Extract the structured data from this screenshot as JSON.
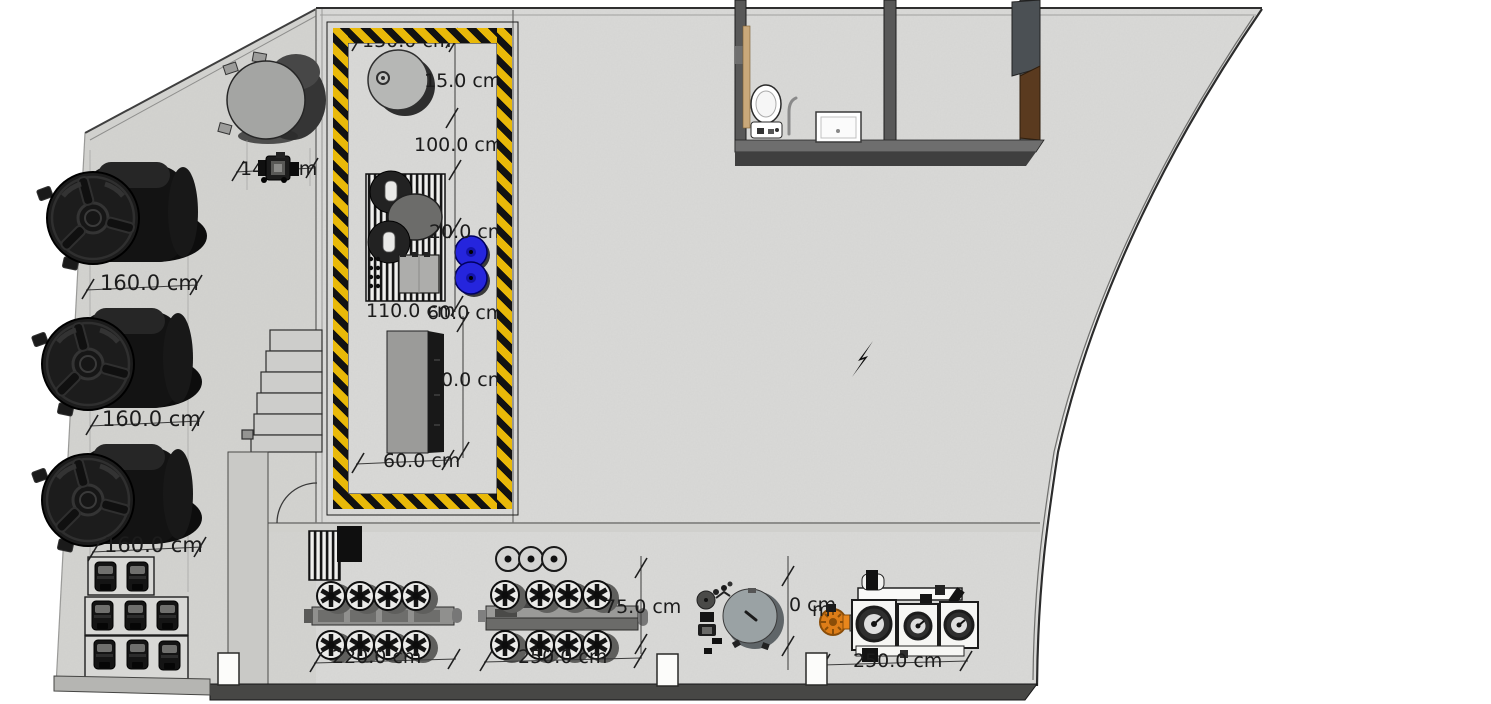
{
  "drawing": {
    "type": "factory-floor-plan",
    "unit": "cm",
    "colors": {
      "floor": "#d8d8d6",
      "floor_left": "#d3d3d0",
      "wall_dark": "#474745",
      "hazard_yellow": "#e9b909",
      "hazard_black": "#121212",
      "tank_black": "#1b1b1b",
      "drum_blue": "#2525dd",
      "gear_orange": "#dd7d18",
      "door_wood": "#c9a87a",
      "panel_brown": "#5a3a1f",
      "dim_text": "#1c1c1c"
    }
  },
  "dimensions": [
    {
      "id": "hazard-zone-width",
      "text": "130.0 cm"
    },
    {
      "id": "hazard-inset",
      "text": "15.0 cm"
    },
    {
      "id": "hazard-length-1",
      "text": "100.0 cm"
    },
    {
      "id": "hazard-length-2",
      "text": "20.0 cm"
    },
    {
      "id": "skid-width",
      "text": "110.0 cm"
    },
    {
      "id": "skid-right-offset",
      "text": "60.0 cm"
    },
    {
      "id": "bench-height-partial",
      "text": "0.0 cm"
    },
    {
      "id": "bench-width",
      "text": "60.0 cm"
    },
    {
      "id": "pump-offset",
      "text": "14.0 cm"
    },
    {
      "id": "tank-1-diameter",
      "text": "160.0 cm"
    },
    {
      "id": "tank-2-diameter",
      "text": "160.0 cm"
    },
    {
      "id": "tank-3-diameter",
      "text": "160.0 cm"
    },
    {
      "id": "line-a-length",
      "text": "220.0 cm"
    },
    {
      "id": "line-b-length",
      "text": "250.0 cm"
    },
    {
      "id": "line-b-depth",
      "text": "75.0 cm"
    },
    {
      "id": "mixer-height-partial",
      "text": "0 cm"
    },
    {
      "id": "line-c-length",
      "text": "250.0 cm"
    },
    {
      "id": "hidden-label-fragment",
      "text": "m"
    }
  ]
}
